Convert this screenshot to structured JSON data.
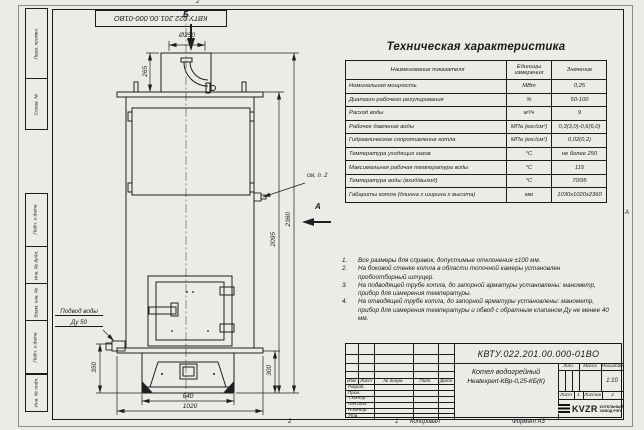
{
  "frame": {
    "top_stamp": "КВТУ.022.201.00.000-01ВО",
    "margin_fields": [
      "Перв. примен.",
      "Справ. №",
      "Подп. и дата",
      "Инв. № дубл.",
      "Взам. инв. №",
      "Подп. и дата",
      "Инв. № подл."
    ],
    "zones": {
      "top": "2",
      "bottom_a": "2",
      "bottom_b": "1",
      "right": "А"
    },
    "footer": {
      "copied": "Копировал",
      "format": "Формат А3"
    }
  },
  "drawing": {
    "section_top": "Б",
    "view_side": "А",
    "callout_sample": "см. п. 2",
    "water_inlet_l1": "Подвод воды",
    "water_inlet_l2": "Ду 50",
    "dims": {
      "d250": "Ø250",
      "h265": "265",
      "h2095": "2095",
      "h2360": "2360",
      "h350": "350",
      "h300": "300",
      "w640": "640",
      "w1020": "1020"
    }
  },
  "spec": {
    "title": "Техническая характеристика",
    "col_name": "Наименование показателя",
    "col_units": "Единицы измерения",
    "col_value": "Значение",
    "rows": [
      {
        "name": "Номинальная мощность",
        "units": "МВт",
        "value": "0,25"
      },
      {
        "name": "Диапазон рабочего регулирования",
        "units": "%",
        "value": "50-100"
      },
      {
        "name": "Расход воды",
        "units": "м³/ч",
        "value": "9"
      },
      {
        "name": "Рабочее давление воды",
        "units": "МПа (кгс/см²)",
        "value": "0,3(3,0)-0,6(6,0)"
      },
      {
        "name": "Гидравлическое сопротивление котла",
        "units": "МПа (кгс/см²)",
        "value": "0,02(0,2)"
      },
      {
        "name": "Температура уходящих газов",
        "units": "°С",
        "value": "не более 250"
      },
      {
        "name": "Максимальная рабочая температура воды",
        "units": "°С",
        "value": "115"
      },
      {
        "name": "Температура воды (вход/выход)",
        "units": "°С",
        "value": "70/95"
      },
      {
        "name": "Габариты котла (длинна х ширина х высота)",
        "units": "мм",
        "value": "1030х1020х2360"
      }
    ]
  },
  "notes": {
    "items": [
      {
        "num": "1.",
        "text": "Все размеры для справок, допустимые отклонения ±100 мм."
      },
      {
        "num": "2.",
        "text": "На боковой стенке котла в области топочной камеры установлен пробоотборный штуцер."
      },
      {
        "num": "3.",
        "text": "На подводящей трубе котла, до запорной арматуры установлены: манометр, прибор для измерения температуры."
      },
      {
        "num": "4.",
        "text": "На отводящей трубе котла, до запорной арматуры установлены: манометр, прибор для измерения температуры и обвод с обратным клапаном Ду не менее 40 мм."
      }
    ]
  },
  "title_block": {
    "doc_number": "КВТУ.022.201.00.000-01ВО",
    "name_line1": "Котел водогрейный",
    "name_line2": "Heatexpert-КВр-0,25-КБ(К)",
    "rev_cols": [
      "Изм.",
      "Лист",
      "№ докум.",
      "Подп.",
      "Дата"
    ],
    "roles": [
      "Разраб.",
      "Пров.",
      "Т.контр.",
      "Нач.отд.",
      "Н.контр.",
      "Утв."
    ],
    "lit": "Лит.",
    "mass": "Масса",
    "scale": "Масштаб",
    "scale_value": "1:10",
    "sheet": "Лист",
    "sheet_no": "1",
    "sheets": "Листов",
    "sheets_no": "2",
    "brand": "KVZR",
    "brand_line1": "КОТЕЛЬНЫЙ",
    "brand_line2": "ЗАВОД РЭП"
  }
}
